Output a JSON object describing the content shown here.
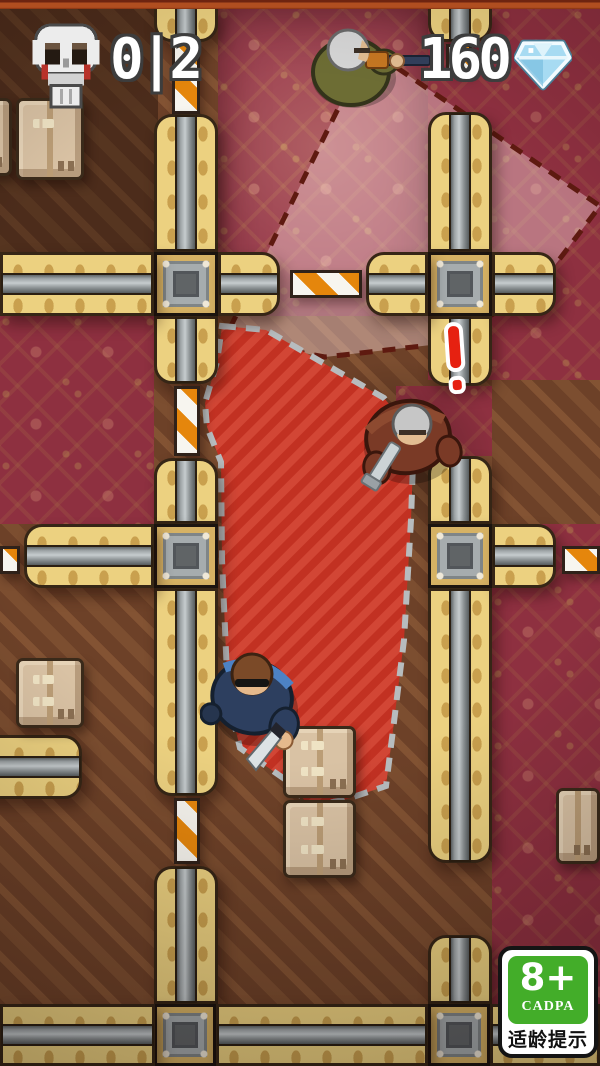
{
  "hud": {
    "kills": {
      "icon": "skull-icon",
      "display": "0|2",
      "current": 0,
      "total": 2
    },
    "currency": {
      "icon": "diamond-icon",
      "value": "160"
    }
  },
  "rating_badge": {
    "age": "8+",
    "org": "CADPA",
    "caption": "适龄提示"
  },
  "scene": {
    "entities": [
      {
        "name": "guard-rifle",
        "desc": "patrolling guard with rifle, top of map"
      },
      {
        "name": "guard-pistol",
        "desc": "alerted guard with pistol, center of map"
      },
      {
        "name": "player-assassin",
        "desc": "player character with knife, lower left"
      }
    ],
    "alert": {
      "icon": "exclamation-icon",
      "color": "#e62111"
    },
    "vision_cones": {
      "alert_cone": "red hatched",
      "patrol_cone": "pale pink"
    }
  },
  "colors": {
    "topbar": "#b04e20",
    "badge-green": "#43ad29",
    "barrier-orange": "#e5860c",
    "cone-red": "#c23122",
    "cone-red-light": "#d24635",
    "gem-blue": "#a7dbf2",
    "wall-yellow": "#ecd180",
    "carpet-maroon": "#8e3040",
    "wood-brown": "#6d4128"
  }
}
